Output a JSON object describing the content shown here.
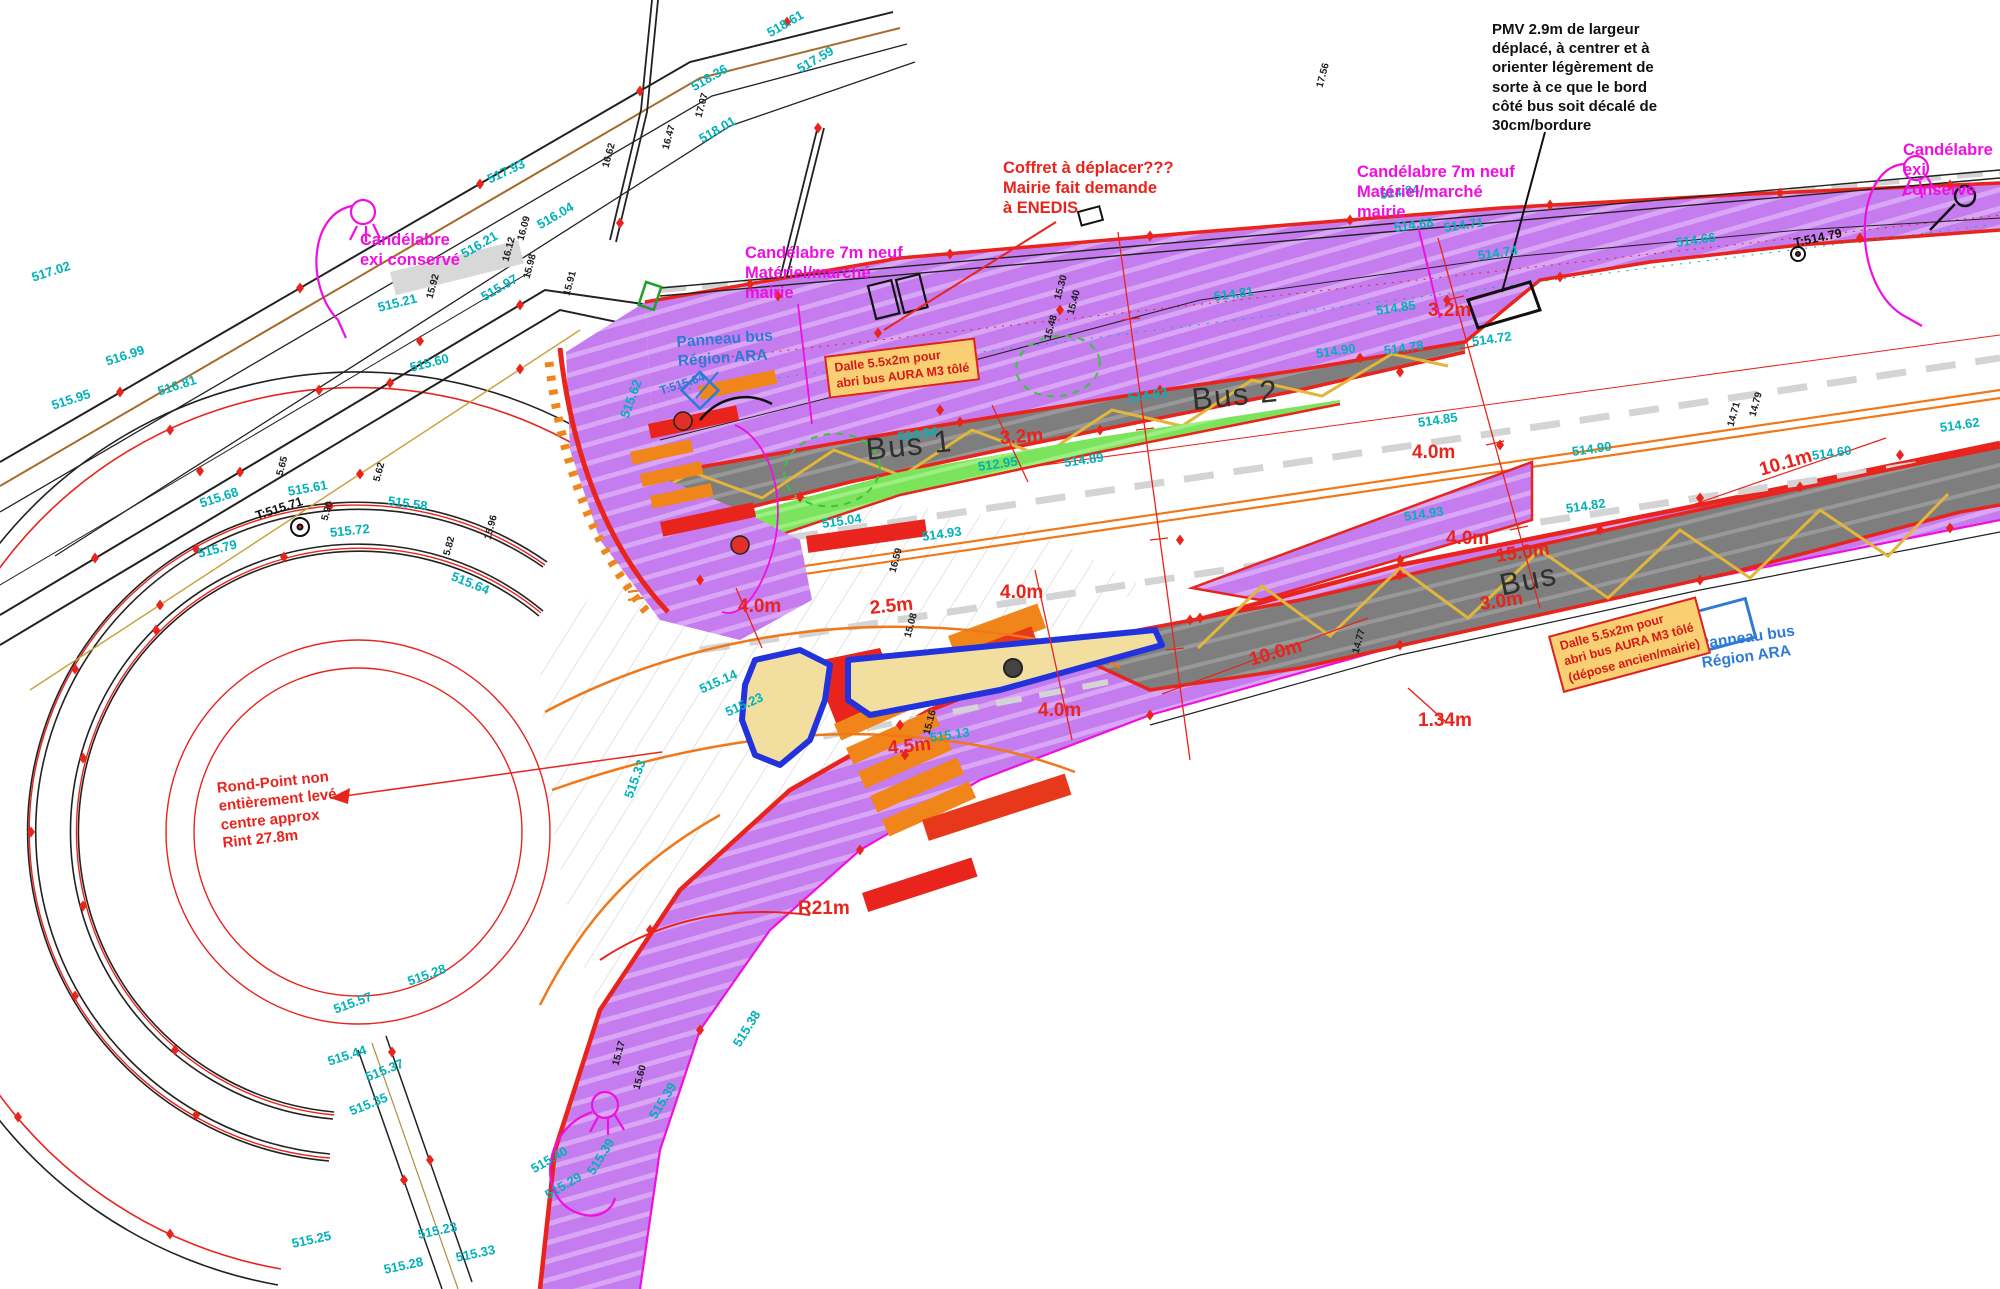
{
  "callouts": {
    "pmv": {
      "text": "PMV 2.9m de largeur\ndéplacé, à centrer et à\norienter légèrement de\nsorte à ce que le bord\ncôté bus soit décalé de\n30cm/bordure"
    },
    "coffret": {
      "text": "Coffret à déplacer???\nMairie fait demande\nà ENEDIS"
    },
    "cand_new_right": {
      "text": "Candélabre 7m neuf\nMatériel/marché\nmairie"
    },
    "cand_new_left": {
      "text": "Candélabre 7m neuf\nMatériel/marché\nmairie"
    },
    "cand_exi_tl": {
      "text": "Candélabre\nexi conservé"
    },
    "cand_exi_tr": {
      "text": "Candélabre\nexi conservé"
    },
    "panneau_tl": {
      "text": "Panneau bus\nRégion ARA"
    },
    "panneau_right": {
      "text": "Panneau bus\nRégion ARA"
    },
    "rondpoint": {
      "text": "Rond-Point non\nentièrement levé,\ncentre approx\nRint 27.8m"
    },
    "dalle_1": {
      "text": "Dalle 5.5x2m pour\nabri bus AURA M3 tôlé"
    },
    "dalle_2": {
      "text": "Dalle 5.5x2m pour\nabri bus AURA M3 tôlé\n(dépose ancien/mairie)"
    },
    "bus1": "Bus 1",
    "bus2": "Bus 2",
    "bus3": "Bus"
  },
  "measurements": [
    {
      "t": "3.2m",
      "x": 1000,
      "y": 428,
      "r": -4
    },
    {
      "t": "3.2m",
      "x": 1428,
      "y": 300,
      "r": 0
    },
    {
      "t": "4.0m",
      "x": 1412,
      "y": 442,
      "r": 0
    },
    {
      "t": "4.0m",
      "x": 1446,
      "y": 528,
      "r": 0
    },
    {
      "t": "4.0m",
      "x": 1000,
      "y": 582,
      "r": 0
    },
    {
      "t": "4.0m",
      "x": 1038,
      "y": 700,
      "r": 0
    },
    {
      "t": "4.0m",
      "x": 738,
      "y": 596,
      "r": 0
    },
    {
      "t": "15.0m",
      "x": 1496,
      "y": 546,
      "r": -8
    },
    {
      "t": "3.0m",
      "x": 1480,
      "y": 594,
      "r": -8
    },
    {
      "t": "10.0m",
      "x": 1250,
      "y": 650,
      "r": -16
    },
    {
      "t": "10.1m",
      "x": 1760,
      "y": 460,
      "r": -16
    },
    {
      "t": "1.34m",
      "x": 1418,
      "y": 710,
      "r": 0
    },
    {
      "t": "4.5m",
      "x": 888,
      "y": 738,
      "r": -6
    },
    {
      "t": "2.5m",
      "x": 870,
      "y": 598,
      "r": -6
    },
    {
      "t": "R21m",
      "x": 798,
      "y": 898,
      "r": 0
    }
  ],
  "survey_labels": [
    {
      "t": "518.61",
      "x": 768,
      "y": 26,
      "r": -30,
      "c": "t"
    },
    {
      "t": "518.36",
      "x": 692,
      "y": 80,
      "r": -30,
      "c": "t"
    },
    {
      "t": "517.59",
      "x": 798,
      "y": 62,
      "r": -30,
      "c": "t"
    },
    {
      "t": "518.01",
      "x": 700,
      "y": 132,
      "r": -30,
      "c": "t"
    },
    {
      "t": "517.93",
      "x": 488,
      "y": 172,
      "r": -25,
      "c": "t"
    },
    {
      "t": "517.02",
      "x": 32,
      "y": 270,
      "r": -18,
      "c": "t"
    },
    {
      "t": "516.99",
      "x": 106,
      "y": 354,
      "r": -18,
      "c": "t"
    },
    {
      "t": "515.95",
      "x": 52,
      "y": 398,
      "r": -18,
      "c": "t"
    },
    {
      "t": "516.81",
      "x": 158,
      "y": 384,
      "r": -18,
      "c": "t"
    },
    {
      "t": "515.60",
      "x": 410,
      "y": 360,
      "r": -14,
      "c": "t"
    },
    {
      "t": "515.21",
      "x": 378,
      "y": 300,
      "r": -14,
      "c": "t"
    },
    {
      "t": "516.21",
      "x": 462,
      "y": 247,
      "r": -30,
      "c": "t"
    },
    {
      "t": "515.97",
      "x": 482,
      "y": 290,
      "r": -30,
      "c": "t"
    },
    {
      "t": "516.04",
      "x": 538,
      "y": 218,
      "r": -30,
      "c": "t"
    },
    {
      "t": "515.68",
      "x": 200,
      "y": 496,
      "r": -18,
      "c": "t"
    },
    {
      "t": "515.61",
      "x": 288,
      "y": 484,
      "r": -10,
      "c": "t"
    },
    {
      "t": "515.58",
      "x": 388,
      "y": 493,
      "r": 8,
      "c": "t"
    },
    {
      "t": "515.79",
      "x": 198,
      "y": 546,
      "r": -14,
      "c": "t"
    },
    {
      "t": "515.72",
      "x": 330,
      "y": 525,
      "r": -6,
      "c": "t"
    },
    {
      "t": "515.64",
      "x": 452,
      "y": 568,
      "r": 22,
      "c": "t"
    },
    {
      "t": "515.44",
      "x": 328,
      "y": 1054,
      "r": -18,
      "c": "t"
    },
    {
      "t": "515.37",
      "x": 366,
      "y": 1070,
      "r": -22,
      "c": "t"
    },
    {
      "t": "515.35",
      "x": 350,
      "y": 1104,
      "r": -22,
      "c": "t"
    },
    {
      "t": "515.57",
      "x": 334,
      "y": 1002,
      "r": -20,
      "c": "t"
    },
    {
      "t": "515.28",
      "x": 408,
      "y": 974,
      "r": -20,
      "c": "t"
    },
    {
      "t": "515.25",
      "x": 292,
      "y": 1236,
      "r": -12,
      "c": "t"
    },
    {
      "t": "515.23",
      "x": 418,
      "y": 1227,
      "r": -12,
      "c": "t"
    },
    {
      "t": "515.28",
      "x": 384,
      "y": 1262,
      "r": -12,
      "c": "t"
    },
    {
      "t": "515.33",
      "x": 456,
      "y": 1250,
      "r": -12,
      "c": "t"
    },
    {
      "t": "515.40",
      "x": 532,
      "y": 1162,
      "r": -30,
      "c": "t"
    },
    {
      "t": "515.29",
      "x": 546,
      "y": 1188,
      "r": -30,
      "c": "t"
    },
    {
      "t": "515.38",
      "x": 736,
      "y": 1038,
      "r": -58,
      "c": "t"
    },
    {
      "t": "515.39",
      "x": 652,
      "y": 1110,
      "r": -58,
      "c": "t"
    },
    {
      "t": "515.39",
      "x": 590,
      "y": 1166,
      "r": -58,
      "c": "t"
    },
    {
      "t": "515.62",
      "x": 624,
      "y": 410,
      "r": -70,
      "c": "t"
    },
    {
      "t": "515.33",
      "x": 628,
      "y": 790,
      "r": -70,
      "c": "t"
    },
    {
      "t": "515.13",
      "x": 930,
      "y": 730,
      "r": -8,
      "c": "t"
    },
    {
      "t": "515.04",
      "x": 822,
      "y": 516,
      "r": -8,
      "c": "t"
    },
    {
      "t": "514.93",
      "x": 922,
      "y": 529,
      "r": -8,
      "c": "t"
    },
    {
      "t": "512.95",
      "x": 978,
      "y": 459,
      "r": -8,
      "c": "t"
    },
    {
      "t": "514.89",
      "x": 1064,
      "y": 455,
      "r": -8,
      "c": "t"
    },
    {
      "t": "514.94",
      "x": 898,
      "y": 429,
      "r": -8,
      "c": "t"
    },
    {
      "t": "514.93",
      "x": 1128,
      "y": 390,
      "r": -8,
      "c": "t"
    },
    {
      "t": "514.81",
      "x": 1214,
      "y": 289,
      "r": -8,
      "c": "t"
    },
    {
      "t": "514.85",
      "x": 1376,
      "y": 303,
      "r": -8,
      "c": "t"
    },
    {
      "t": "514.78",
      "x": 1384,
      "y": 343,
      "r": -8,
      "c": "t"
    },
    {
      "t": "514.90",
      "x": 1316,
      "y": 346,
      "r": -8,
      "c": "t"
    },
    {
      "t": "514.72",
      "x": 1472,
      "y": 334,
      "r": -8,
      "c": "t"
    },
    {
      "t": "514.85",
      "x": 1418,
      "y": 415,
      "r": -8,
      "c": "t"
    },
    {
      "t": "514.90",
      "x": 1572,
      "y": 444,
      "r": -8,
      "c": "t"
    },
    {
      "t": "514.93",
      "x": 1404,
      "y": 509,
      "r": -8,
      "c": "t"
    },
    {
      "t": "514.82",
      "x": 1566,
      "y": 501,
      "r": -8,
      "c": "t"
    },
    {
      "t": "514.84",
      "x": 1380,
      "y": 187,
      "r": -8,
      "c": "t"
    },
    {
      "t": "514.71",
      "x": 1444,
      "y": 220,
      "r": -8,
      "c": "t"
    },
    {
      "t": "514.68",
      "x": 1394,
      "y": 220,
      "r": -8,
      "c": "t"
    },
    {
      "t": "514.74",
      "x": 1478,
      "y": 248,
      "r": -8,
      "c": "t"
    },
    {
      "t": "514.66",
      "x": 1676,
      "y": 235,
      "r": -8,
      "c": "t"
    },
    {
      "t": "514.60",
      "x": 1812,
      "y": 448,
      "r": -8,
      "c": "t"
    },
    {
      "t": "514.62",
      "x": 1940,
      "y": 420,
      "r": -8,
      "c": "t"
    },
    {
      "t": "515.14",
      "x": 700,
      "y": 682,
      "r": -24,
      "c": "t"
    },
    {
      "t": "515.23",
      "x": 726,
      "y": 705,
      "r": -24,
      "c": "t"
    },
    {
      "t": "T:515.64",
      "x": 660,
      "y": 384,
      "r": -18,
      "c": "b"
    },
    {
      "t": "T:515.71",
      "x": 256,
      "y": 509,
      "r": -18,
      "c": "k2"
    },
    {
      "t": "T:514.79",
      "x": 1794,
      "y": 236,
      "r": -12,
      "c": "k2"
    },
    {
      "t": "17.56",
      "x": 1320,
      "y": 82,
      "r": -75,
      "c": "k"
    },
    {
      "t": "17.07",
      "x": 699,
      "y": 112,
      "r": -75,
      "c": "k"
    },
    {
      "t": "16.62",
      "x": 606,
      "y": 162,
      "r": -75,
      "c": "k"
    },
    {
      "t": "16.47",
      "x": 666,
      "y": 144,
      "r": -75,
      "c": "k"
    },
    {
      "t": "16.12",
      "x": 506,
      "y": 256,
      "r": -75,
      "c": "k"
    },
    {
      "t": "16.09",
      "x": 521,
      "y": 235,
      "r": -75,
      "c": "k"
    },
    {
      "t": "15.98",
      "x": 527,
      "y": 273,
      "r": -75,
      "c": "k"
    },
    {
      "t": "15.91",
      "x": 567,
      "y": 290,
      "r": -75,
      "c": "k"
    },
    {
      "t": "15.92",
      "x": 430,
      "y": 293,
      "r": -75,
      "c": "k"
    },
    {
      "t": "5.65",
      "x": 280,
      "y": 470,
      "r": -75,
      "c": "k"
    },
    {
      "t": "5.62",
      "x": 377,
      "y": 476,
      "r": -75,
      "c": "k"
    },
    {
      "t": "5.90",
      "x": 325,
      "y": 515,
      "r": -75,
      "c": "k"
    },
    {
      "t": "5.82",
      "x": 447,
      "y": 550,
      "r": -75,
      "c": "k"
    },
    {
      "t": "15.96",
      "x": 488,
      "y": 534,
      "r": -75,
      "c": "k"
    },
    {
      "t": "15.17",
      "x": 616,
      "y": 1060,
      "r": -75,
      "c": "k"
    },
    {
      "t": "15.60",
      "x": 637,
      "y": 1084,
      "r": -75,
      "c": "k"
    },
    {
      "t": "14.77",
      "x": 1356,
      "y": 648,
      "r": -75,
      "c": "k"
    },
    {
      "t": "14.71",
      "x": 1731,
      "y": 421,
      "r": -75,
      "c": "k"
    },
    {
      "t": "14.79",
      "x": 1753,
      "y": 411,
      "r": -75,
      "c": "k"
    },
    {
      "t": "15.16",
      "x": 927,
      "y": 729,
      "r": -75,
      "c": "k"
    },
    {
      "t": "15.30",
      "x": 1058,
      "y": 294,
      "r": -75,
      "c": "k"
    },
    {
      "t": "15.40",
      "x": 1071,
      "y": 309,
      "r": -75,
      "c": "k"
    },
    {
      "t": "15.48",
      "x": 1048,
      "y": 334,
      "r": -75,
      "c": "k"
    },
    {
      "t": "15.08",
      "x": 908,
      "y": 632,
      "r": -75,
      "c": "k"
    },
    {
      "t": "16.59",
      "x": 893,
      "y": 567,
      "r": -75,
      "c": "k"
    }
  ],
  "colors": {
    "purple": "#c47cee",
    "lane_gray": "#7e7e7e",
    "green": "#7ce35c",
    "red": "#e8241c",
    "magenta": "#f00fe0",
    "teal": "#00b2b8",
    "blue": "#2d7bd6",
    "orange": "#f0861a",
    "yellow": "#e2b63a",
    "beige": "#f2dfa0",
    "island_blue": "#2233dd"
  }
}
